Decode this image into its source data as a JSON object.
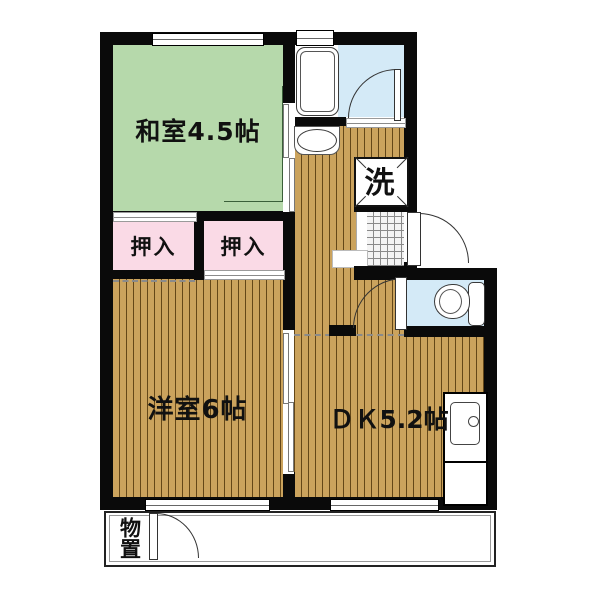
{
  "plan_title": "2DK apartment floor plan",
  "rooms": {
    "japanese_room": {
      "label": "和室4.5帖",
      "type": "tatami room",
      "size_jo": 4.5
    },
    "closet_1": {
      "label": "押入",
      "type": "closet"
    },
    "closet_2": {
      "label": "押入",
      "type": "closet"
    },
    "western_room": {
      "label": "洋室6帖",
      "type": "western room",
      "size_jo": 6
    },
    "dining_kitchen": {
      "label": "ＤＫ5.2帖",
      "type": "dining kitchen",
      "size_jo": 5.2
    },
    "laundry": {
      "label": "洗",
      "type": "washing machine space"
    },
    "storage": {
      "label": "物置",
      "type": "outdoor storage"
    }
  },
  "fixtures": [
    "bathtub",
    "washbasin",
    "toilet",
    "kitchen-sink",
    "kitchen-counter",
    "washing-machine-pan",
    "entrance-tile"
  ],
  "colors": {
    "wall": "#0a0a0a",
    "tatami_green": "#b6d9ab",
    "closet_pink": "#fadae6",
    "wood_floor": "#cba35d",
    "wet_area_blue": "#d4eaf7",
    "tile_gray": "#f4f4f4",
    "background": "#ffffff"
  }
}
